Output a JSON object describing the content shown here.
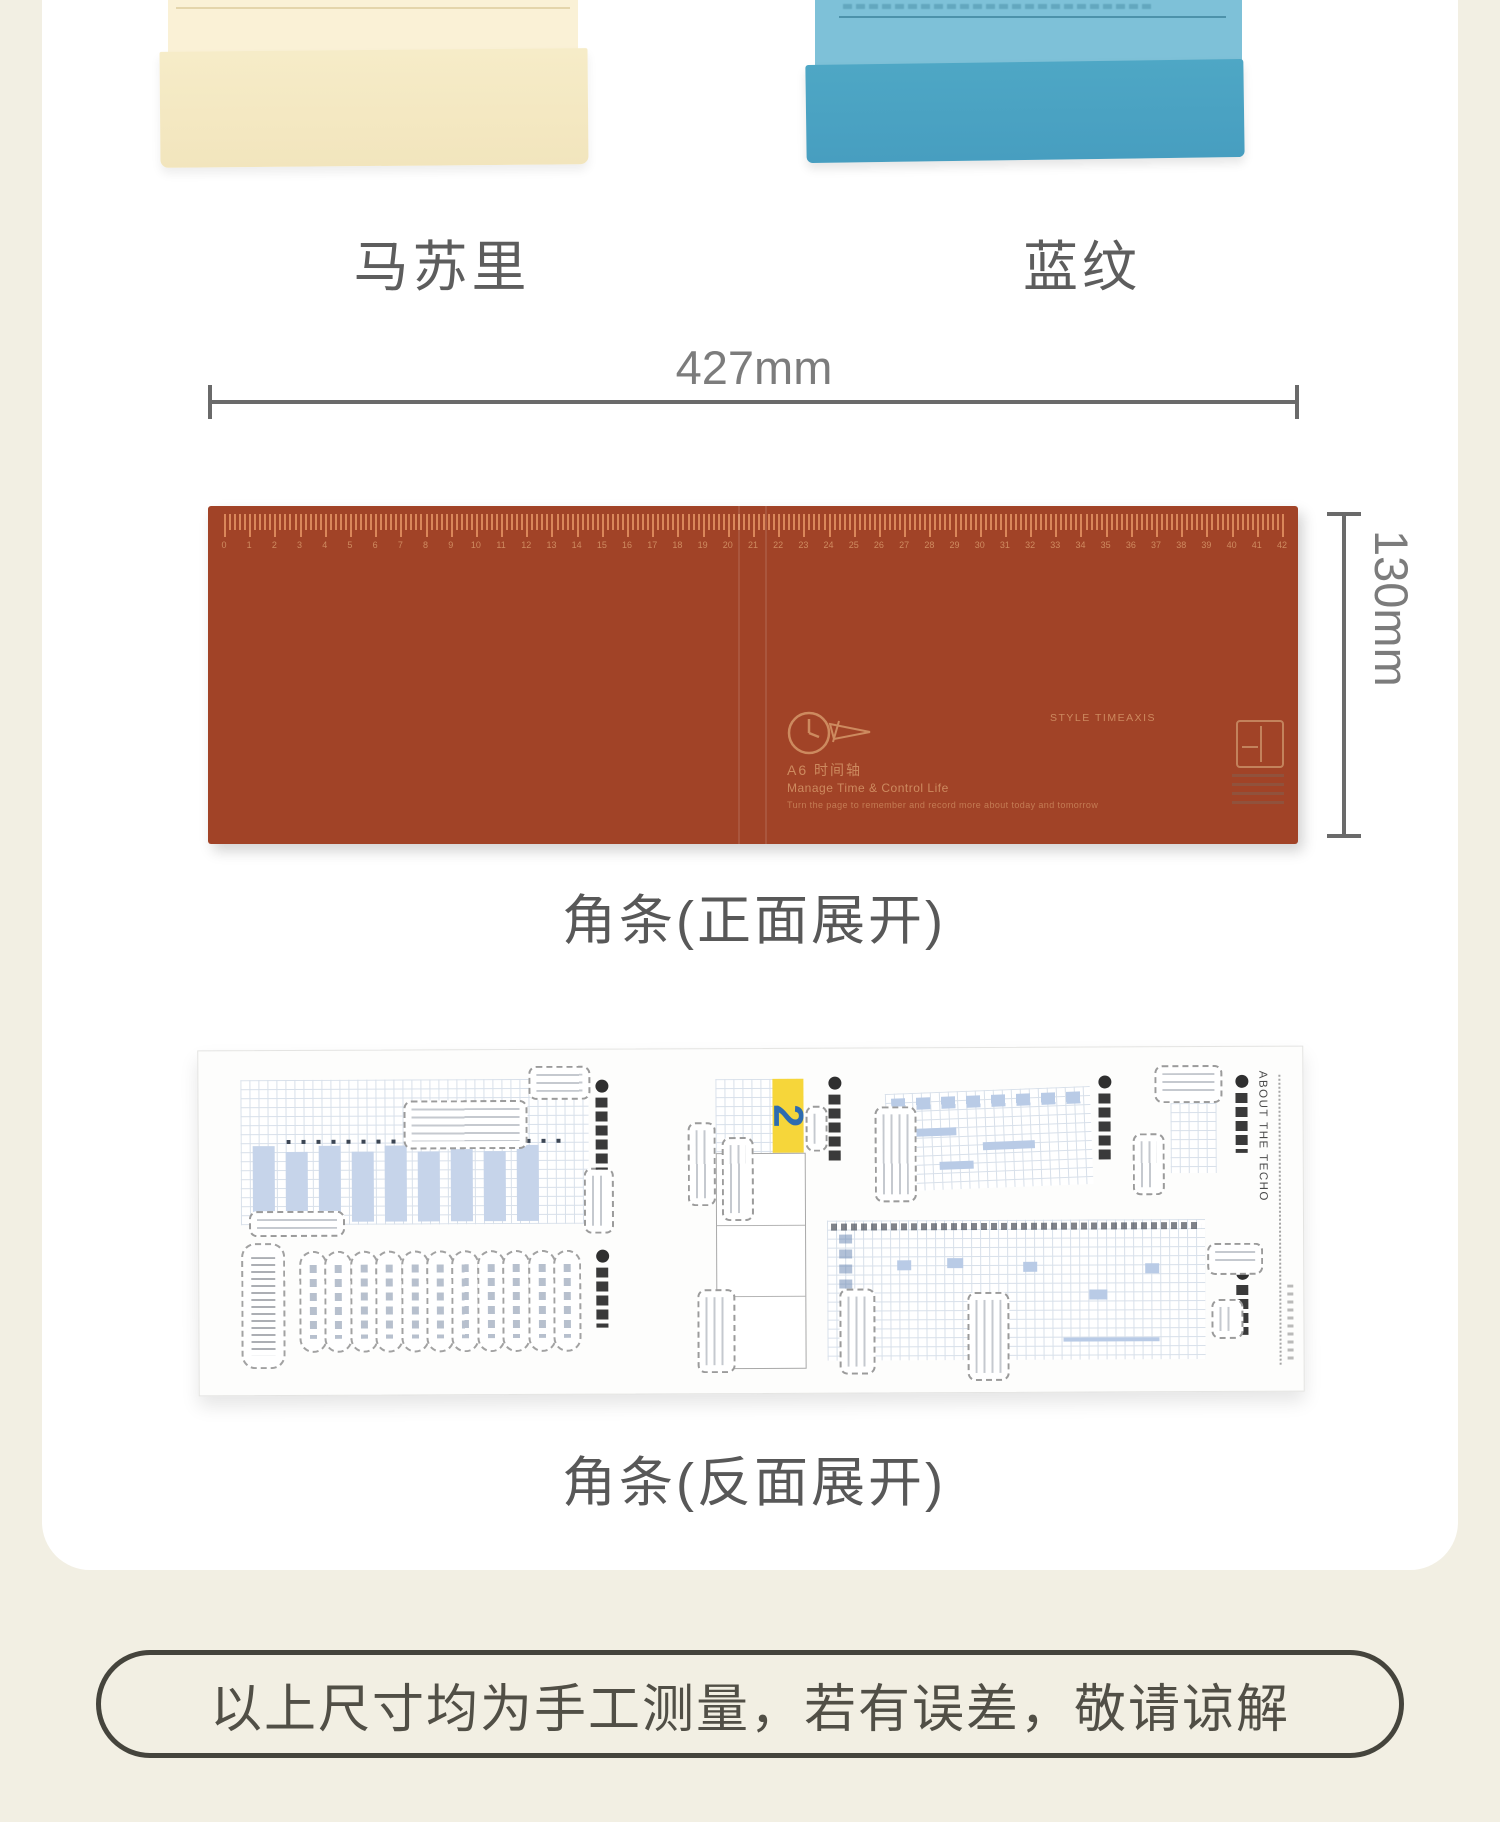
{
  "colors": {
    "page_bg": "#f2efe3",
    "card_bg": "#ffffff",
    "cream_cover_top": "#faf1d6",
    "cream_cover_flap": "#f4e8c2",
    "blue_cover_top": "#7ec1d8",
    "blue_cover_flap": "#49a1c1",
    "front_strip": "#a14327",
    "ruler_marks": "#cf8b60",
    "dimension_gray": "#6a6a6a",
    "highlight_yellow": "#f6d63a",
    "page_number_blue": "#2e6cb0"
  },
  "products": [
    {
      "name": "马苏里"
    },
    {
      "name": "蓝纹"
    }
  ],
  "front": {
    "width_label": "427mm",
    "height_label": "130mm",
    "caption": "角条(正面展开)",
    "ruler": {
      "unit_count": 42,
      "minor_per_unit": 5
    },
    "print": {
      "series": "A6 时间轴",
      "subtitle": "Manage Time & Control Life",
      "tagline": "Turn the page to remember and record more about today and tomorrow",
      "style_label": "STYLE TIMEAXIS"
    }
  },
  "back": {
    "caption": "角条(反面展开)",
    "about_label": "ABOUT THE TECHO",
    "page_number": "2",
    "capsule_count": 11,
    "bar_count": 9
  },
  "note": {
    "text": "以上尺寸均为手工测量，若有误差，敬请谅解"
  }
}
